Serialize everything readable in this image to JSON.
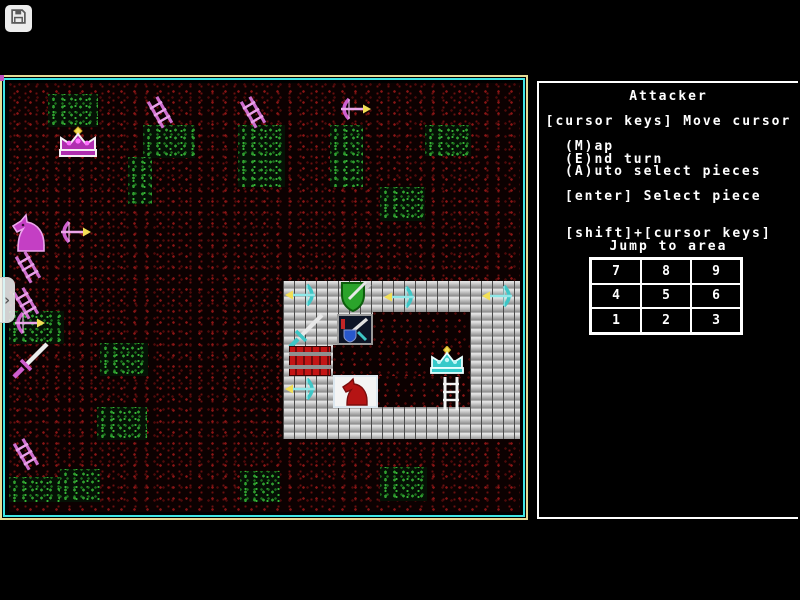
{
  "browser": {
    "save_button_icon": "floppy-disk-icon",
    "sidebar_toggle_glyph": "›"
  },
  "panel": {
    "title": "Attacker",
    "lines": {
      "move": "[cursor keys] Move cursor",
      "map": "(M)ap",
      "end": "(E)nd turn",
      "auto": "(A)uto select pieces",
      "select": "[enter] Select piece",
      "shift": "[shift]+[cursor keys]",
      "jump": "Jump to area"
    },
    "jump_grid": [
      "7",
      "8",
      "9",
      "4",
      "5",
      "6",
      "1",
      "2",
      "3"
    ]
  },
  "map": {
    "terrain": {
      "floor": "dark-red-speckle",
      "grass": "green-speckle",
      "castle": "gray-brick",
      "courtyard": "dark-red-speckle"
    },
    "pieces": [
      {
        "type": "ladder",
        "side": "attacker",
        "color": "magenta",
        "x": 152,
        "y": 98
      },
      {
        "type": "ladder",
        "side": "attacker",
        "color": "magenta",
        "x": 245,
        "y": 98
      },
      {
        "type": "bow-arrow-right",
        "side": "attacker",
        "color": "magenta",
        "x": 338,
        "y": 99
      },
      {
        "type": "crown",
        "side": "attacker",
        "color": "magenta",
        "x": 57,
        "y": 128
      },
      {
        "type": "knight",
        "side": "attacker",
        "color": "magenta",
        "x": 12,
        "y": 215
      },
      {
        "type": "bow-arrow-right",
        "side": "attacker",
        "color": "magenta",
        "x": 58,
        "y": 222
      },
      {
        "type": "ladder",
        "side": "attacker",
        "color": "magenta",
        "x": 20,
        "y": 253
      },
      {
        "type": "ladder",
        "side": "attacker",
        "color": "magenta",
        "x": 18,
        "y": 289
      },
      {
        "type": "bow-arrow-right",
        "side": "attacker",
        "color": "magenta",
        "x": 12,
        "y": 313
      },
      {
        "type": "sword",
        "side": "attacker",
        "color": "magenta",
        "x": 10,
        "y": 343
      },
      {
        "type": "ladder",
        "side": "attacker",
        "color": "magenta",
        "x": 18,
        "y": 440
      },
      {
        "type": "bow-arrow-left",
        "side": "defender",
        "color": "cyan",
        "x": 286,
        "y": 285
      },
      {
        "type": "shield-sword",
        "side": "defender",
        "color": "green",
        "x": 338,
        "y": 283
      },
      {
        "type": "bow-arrow-left",
        "side": "defender",
        "color": "cyan",
        "x": 385,
        "y": 287
      },
      {
        "type": "bow-arrow-left",
        "side": "defender",
        "color": "cyan",
        "x": 483,
        "y": 286
      },
      {
        "type": "sword",
        "side": "defender",
        "color": "cyan",
        "x": 286,
        "y": 315
      },
      {
        "type": "sword-shield-emblem",
        "side": "defender",
        "color": "blue",
        "x": 339,
        "y": 317
      },
      {
        "type": "crate",
        "side": "defender",
        "color": "red",
        "x": 291,
        "y": 349
      },
      {
        "type": "bow-arrow-left",
        "side": "defender",
        "color": "cyan",
        "x": 286,
        "y": 379
      },
      {
        "type": "knight-cursor",
        "side": "defender",
        "color": "red-on-white",
        "x": 335,
        "y": 378
      },
      {
        "type": "crown",
        "side": "defender",
        "color": "cyan",
        "x": 429,
        "y": 349
      },
      {
        "type": "ladder",
        "side": "defender",
        "color": "white",
        "x": 440,
        "y": 379
      }
    ]
  },
  "colors": {
    "attacker_piece": "#cf5fcf",
    "defender_piece": "#3ec6c6",
    "arrow_head": "#f2df55",
    "map_border_outer": "#e6dc96",
    "map_border_inner": "#3ee6e6",
    "panel_border": "#ffffff",
    "panel_text": "#ffffff",
    "grass": "#2f9e2f",
    "floor_speckle": "#8a1515",
    "castle_brick": "#b0b0b0"
  }
}
